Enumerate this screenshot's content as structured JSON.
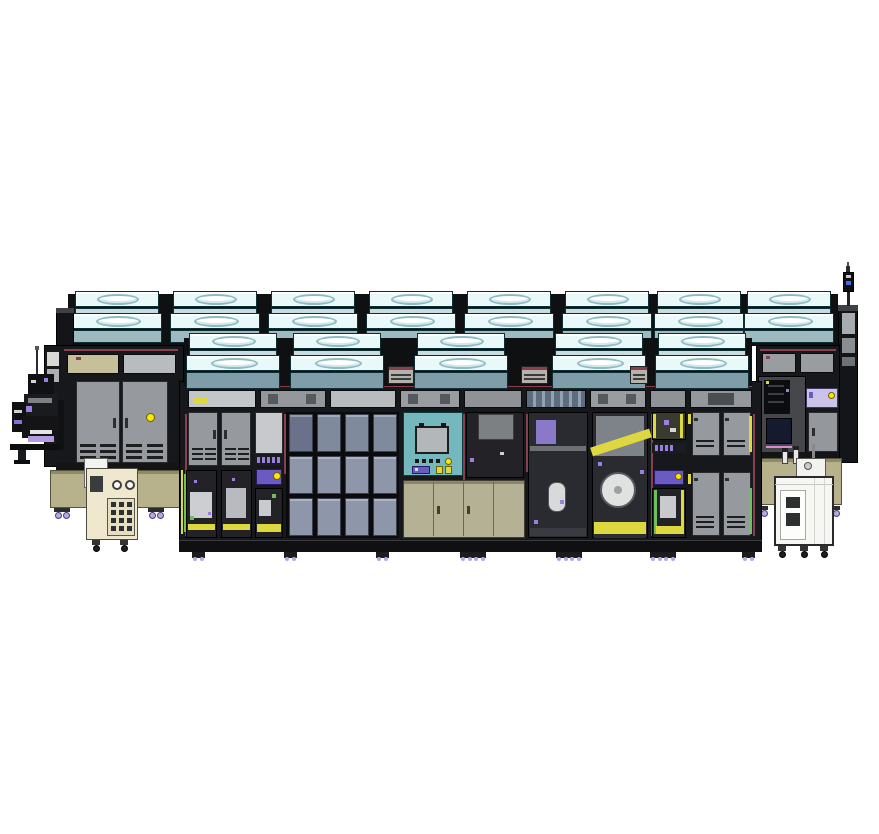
{
  "scene": {
    "type": "cad-elevation-rendering",
    "description": "Side elevation CAD rendering of an inline cleanroom production line with rooftop fan filter units, glass-panel enclosures, interior robots, service carts, robot loader tower and a signal beacon",
    "background": "#ffffff",
    "width": 879,
    "height": 834
  },
  "palette": {
    "outline": "#000000",
    "frame": "#17181b",
    "frame_mid": "#2b2c30",
    "backdrop": "#0f1012",
    "maroon": "#8a3f4e",
    "ffu_top": "#e9f8f9",
    "ffu_oval": "#ffffff",
    "ffu_oval_ring": "#8fbac2",
    "ffu_face_light": "#c6dce0",
    "ffu_face_mid": "#9dbac1",
    "ffu_face_dark": "#7f9da8",
    "door_gray": "#96999d",
    "panel_light": "#c7c9cc",
    "vent_dark": "#1d1e20",
    "khaki": "#b7b28b",
    "khaki_light": "#c5c09a",
    "khaki_dark": "#55543c",
    "glass": "#8d97a9",
    "glass_dark": "#69728a",
    "interior": "#232327",
    "interior2": "#2a2b30",
    "teal": "#74b7bd",
    "monitor": "#b4b7b9",
    "lavender": "#cbc3ea",
    "purple": "#6a5ac2",
    "purple_light": "#9b7fe0",
    "violet_strip": "#b49ae0",
    "yellow": "#ffe600",
    "yellow_soft": "#ddd83f",
    "green": "#6fbf5e",
    "white_cart": "#f6f6f3",
    "cream": "#efe8cf",
    "screen_navy": "#161a2e",
    "caster": "#b9a6e6",
    "caster_dark": "#4a3f77",
    "steel": "#9aa0a2",
    "beacon_blue": "#3f6fe0",
    "pink_line": "#d98ad0"
  },
  "layout": {
    "back_ffus": {
      "y": 291,
      "w": 90,
      "xs": [
        72,
        170,
        268,
        366,
        464,
        562,
        654,
        744
      ]
    },
    "front_ffus": {
      "y": 333,
      "w": 94,
      "xs": [
        186,
        290,
        414,
        552,
        655
      ]
    },
    "gap_vents": [
      {
        "x": 388,
        "w": 26
      },
      {
        "x": 521,
        "w": 27
      },
      {
        "x": 630,
        "w": 18
      }
    ],
    "glass_grid": {
      "x": 289,
      "y": 414,
      "cols": 4,
      "rows": 3,
      "pw": 24,
      "ph": 38,
      "sx": 28,
      "sy": 42
    },
    "clerestory_front": [
      {
        "x": 188,
        "w": 68,
        "tint": "#c3c6c9",
        "accent": "yellow"
      },
      {
        "x": 260,
        "w": 66,
        "tint": "#94989c",
        "accent": "cells"
      },
      {
        "x": 330,
        "w": 66,
        "tint": "#b9bcbf",
        "accent": "none"
      },
      {
        "x": 400,
        "w": 60,
        "tint": "#9a9da0",
        "accent": "cells"
      },
      {
        "x": 464,
        "w": 58,
        "tint": "#8f9296",
        "accent": "none"
      },
      {
        "x": 526,
        "w": 60,
        "tint": "#5f6c7c",
        "accent": "stripes"
      },
      {
        "x": 590,
        "w": 56,
        "tint": "#9a9da0",
        "accent": "cells"
      },
      {
        "x": 650,
        "w": 36,
        "tint": "#8f9296",
        "accent": "none"
      },
      {
        "x": 690,
        "w": 62,
        "tint": "#94989c",
        "accent": "dark"
      }
    ],
    "maroon_posts": [
      {
        "x": 185,
        "y": 414,
        "h": 122
      },
      {
        "x": 284,
        "y": 414,
        "h": 60
      },
      {
        "x": 463,
        "y": 414,
        "h": 122
      },
      {
        "x": 526,
        "y": 414,
        "h": 58
      },
      {
        "x": 651,
        "y": 414,
        "h": 122
      },
      {
        "x": 753,
        "y": 414,
        "h": 122
      }
    ],
    "front_feet_xs": [
      192,
      284,
      376,
      460,
      473,
      556,
      569,
      650,
      663,
      742
    ],
    "left_casters_xs": [
      54,
      148
    ],
    "right_casters_xs": [
      752,
      824
    ],
    "white_cart_caster_xs": [
      778,
      800,
      820
    ],
    "cream_cart_caster_xs": [
      92,
      120
    ],
    "connector_rows": [
      {
        "x": 257,
        "y": 457,
        "n": 5
      },
      {
        "x": 655,
        "y": 445,
        "n": 4
      }
    ],
    "keypad": {
      "cols": 3,
      "rows": 4
    }
  }
}
